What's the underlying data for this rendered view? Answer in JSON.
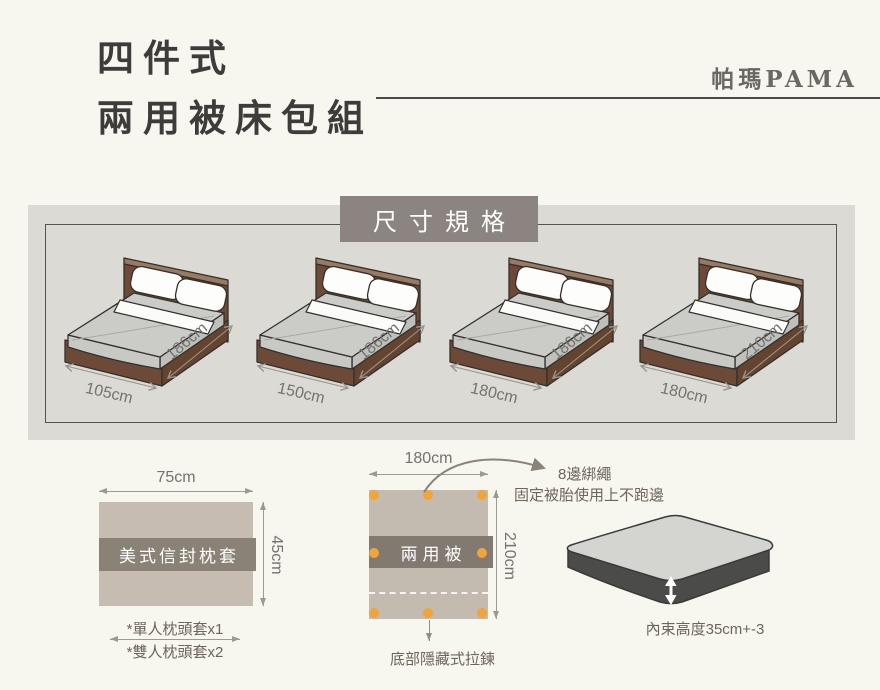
{
  "header": {
    "title_line1": "四件式",
    "title_line2": "兩用被床包組",
    "brand": "帕瑪PAMA"
  },
  "size_section": {
    "title": "尺寸規格",
    "beds": [
      {
        "width": "105cm",
        "length": "186cm"
      },
      {
        "width": "150cm",
        "length": "186cm"
      },
      {
        "width": "180cm",
        "length": "186cm"
      },
      {
        "width": "180cm",
        "length": "210cm"
      }
    ]
  },
  "pillowcase": {
    "width": "75cm",
    "height": "45cm",
    "label": "美式信封枕套",
    "note_single": "*單人枕頭套x1",
    "note_double": "*雙人枕頭套x2"
  },
  "duvet": {
    "width": "180cm",
    "height": "210cm",
    "label": "兩用被",
    "tie_title": "8邊綁繩",
    "tie_desc": "固定被胎使用上不跑邊",
    "zipper_note": "底部隱藏式拉鍊"
  },
  "mattress": {
    "note": "內束高度35cm+-3"
  },
  "colors": {
    "background": "#f7f6ef",
    "panel_bg": "#dbdad4",
    "label_box_bg": "#8b8480",
    "fabric_beige": "#c6bcb2",
    "fabric_band": "#8a8177",
    "accent_orange": "#f0a43c",
    "bed_wood_brown": "#6d4a37",
    "mattress_gray": "#cbcbc8",
    "text_dark": "#3e3c3a",
    "text_annotation": "#6d655a"
  }
}
